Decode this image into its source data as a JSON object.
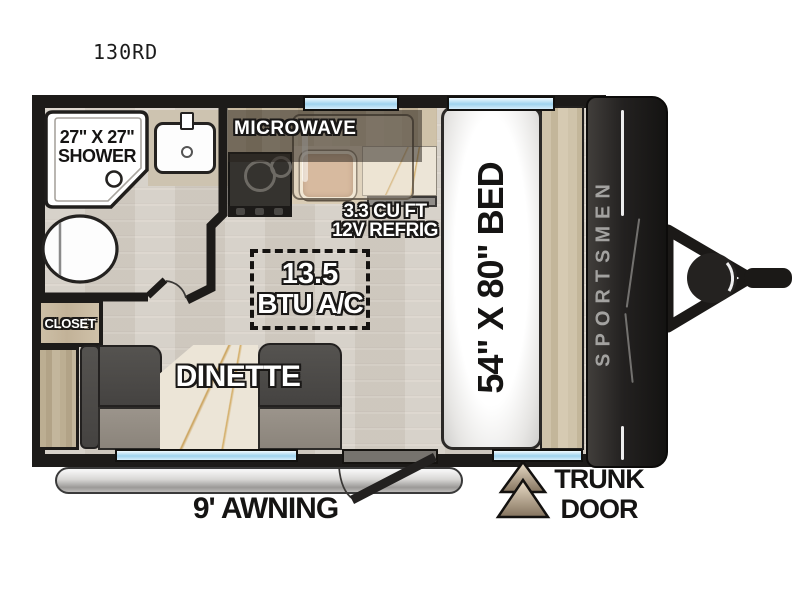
{
  "title": "130RD",
  "rooms": {
    "shower": {
      "size": "27\" X 27\"",
      "label": "SHOWER"
    },
    "kitchen": {
      "microwave": "MICROWAVE",
      "refrigerator_size": "3.3 CU FT",
      "refrigerator": "12V REFRIG"
    },
    "ac": {
      "size": "13.5",
      "label": "BTU A/C"
    },
    "closet": {
      "label": "CLOSET"
    },
    "dinette": {
      "label": "DINETTE"
    },
    "bed": {
      "label": "54\" X 80\" BED"
    }
  },
  "exterior": {
    "brand": "SPORTSMEN",
    "awning": "9' AWNING",
    "trunk_door_line1": "TRUNK",
    "trunk_door_line2": "DOOR"
  },
  "colors": {
    "wall": "#1d1b19",
    "floor": "#d3cdc4",
    "window_blue": "#9fd3ee",
    "wood": "#c7b9a0",
    "bench_gray": "#4c4a48",
    "cap_black": "#201e1c",
    "brand_text": "#a3a2a0",
    "marble": "#ece5d7"
  }
}
